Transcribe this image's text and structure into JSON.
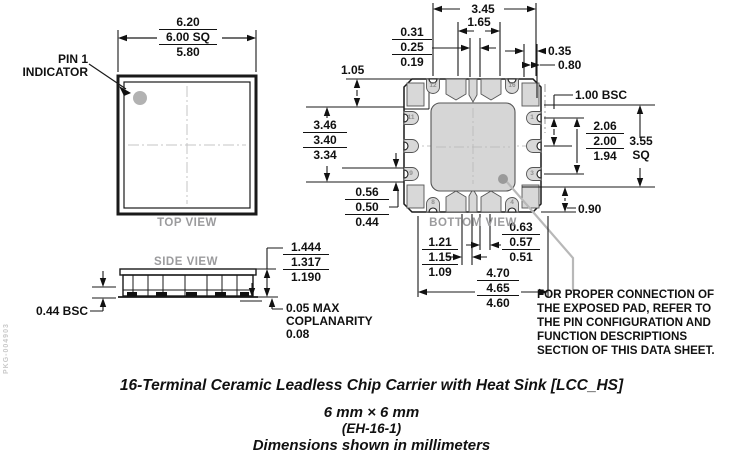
{
  "watermark": "PKG-004903",
  "colors": {
    "line": "#111111",
    "terminal_fill": "#d8d8d8",
    "pad_fill": "#d6d6d6",
    "view_label_gray": "#9b9b9d"
  },
  "top_view": {
    "label": "TOP VIEW",
    "pin1_line1": "PIN 1",
    "pin1_line2": "INDICATOR",
    "size": [
      "6.20",
      "6.00 SQ",
      "5.80"
    ]
  },
  "side_view": {
    "label": "SIDE VIEW",
    "height": [
      "1.444",
      "1.317",
      "1.190"
    ],
    "lead_pitch": "0.44 BSC",
    "coplanarity": [
      "0.05 MAX",
      "COPLANARITY",
      "0.08"
    ]
  },
  "bottom_view": {
    "label": "BOTTOM VIEW",
    "terminals": {
      "n12": "12",
      "n16": "16",
      "n11": "11",
      "n9": "9",
      "n1": "1",
      "n3": "3",
      "n8": "8",
      "n4": "4"
    },
    "dims": {
      "d345": "3.45",
      "d165": "1.65",
      "s031": [
        "0.31",
        "0.25",
        "0.19"
      ],
      "d035": "0.35",
      "d080": "0.80",
      "d105": "1.05",
      "s346": [
        "3.46",
        "3.40",
        "3.34"
      ],
      "s056": [
        "0.56",
        "0.50",
        "0.44"
      ],
      "d100": "1.00 BSC",
      "s206": [
        "2.06",
        "2.00",
        "1.94"
      ],
      "d355_line1": "3.55",
      "d355_line2": "SQ",
      "d090": "0.90",
      "s063": [
        "0.63",
        "0.57",
        "0.51"
      ],
      "s121": [
        "1.21",
        "1.15",
        "1.09"
      ],
      "s470": [
        "4.70",
        "4.65",
        "4.60"
      ]
    },
    "note": [
      "FOR PROPER CONNECTION OF",
      "THE EXPOSED PAD, REFER TO",
      "THE PIN CONFIGURATION AND",
      "FUNCTION DESCRIPTIONS",
      "SECTION OF THIS DATA SHEET."
    ]
  },
  "caption": {
    "line1": "16-Terminal Ceramic Leadless Chip Carrier with Heat Sink [LCC_HS]",
    "line2": "6 mm × 6 mm",
    "line3": "(EH-16-1)",
    "line4": "Dimensions shown in millimeters"
  }
}
